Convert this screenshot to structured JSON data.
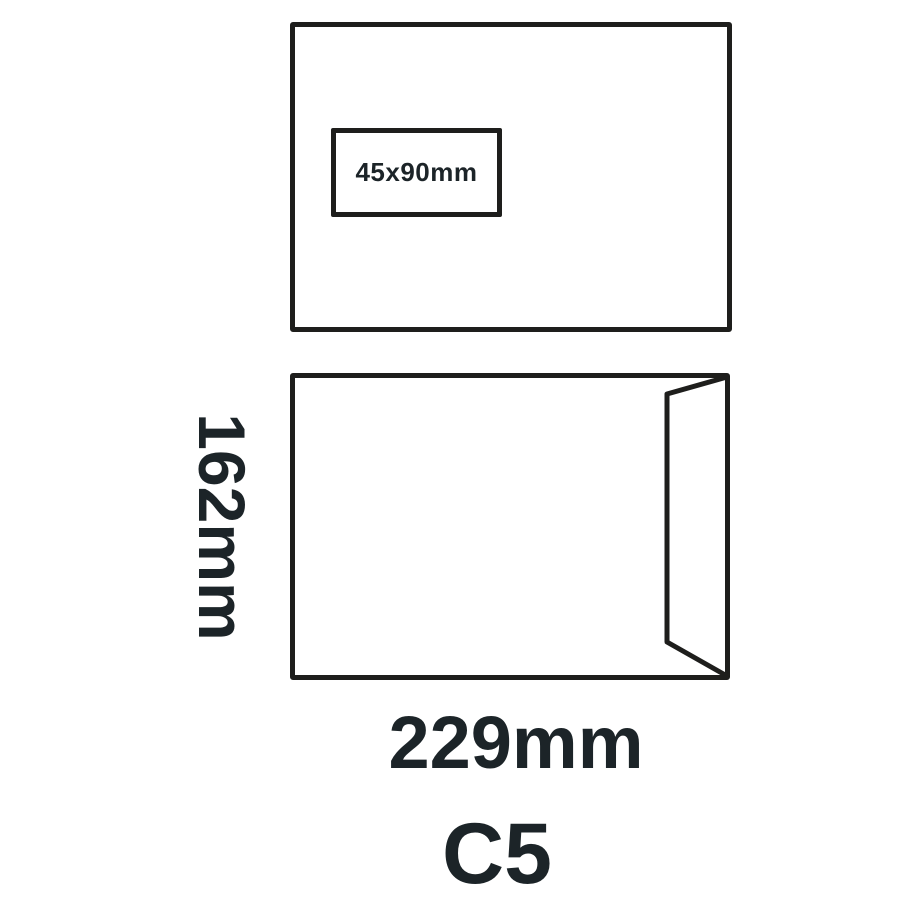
{
  "diagram": {
    "size_title": "C5",
    "width_label": "229mm",
    "height_label": "162mm",
    "window_label": "45x90mm"
  },
  "colors": {
    "line": "#1e1e1c",
    "text": "#1c2428",
    "background": "#ffffff"
  }
}
